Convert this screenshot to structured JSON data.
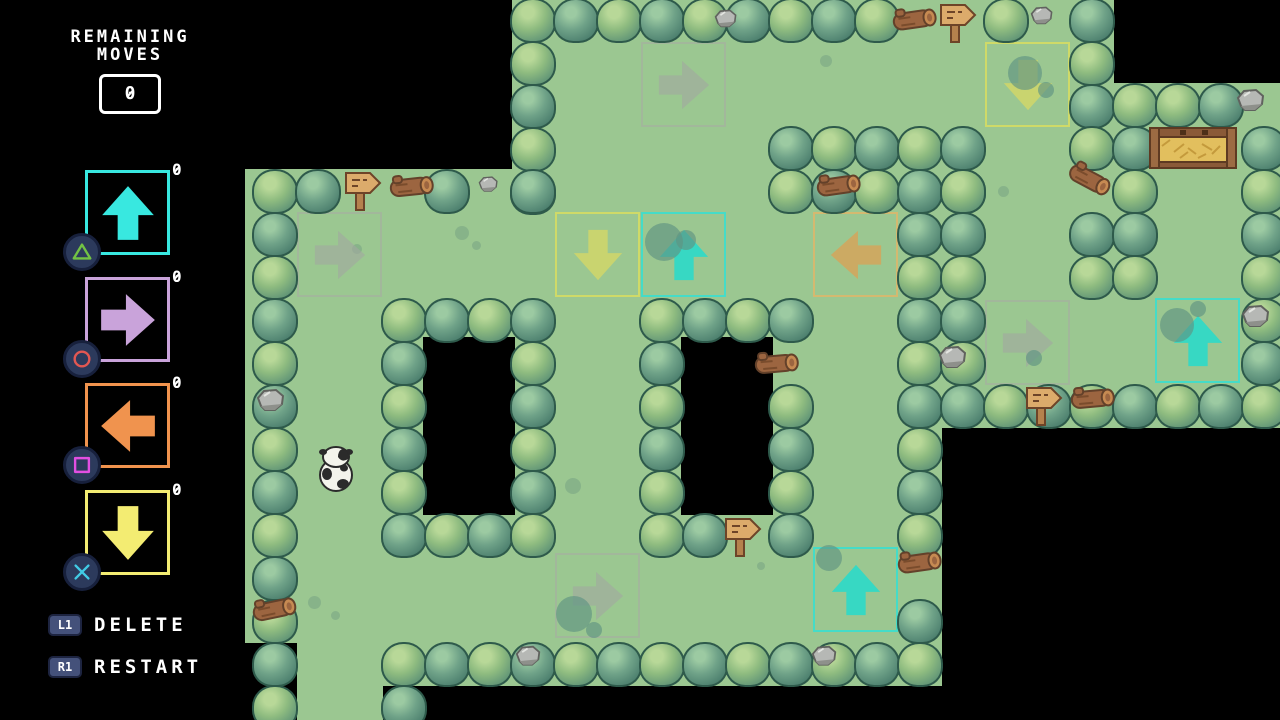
{
  "hud": {
    "remaining_moves": {
      "label_line1": "REMAINING",
      "label_line2": "MOVES",
      "value": "0"
    },
    "arrow_buttons": [
      {
        "direction": "up",
        "count": "0",
        "color": "#38e8e0",
        "ps_button": "triangle",
        "ps_color": "#72c244"
      },
      {
        "direction": "right",
        "count": "0",
        "color": "#c9a3da",
        "ps_button": "circle",
        "ps_color": "#e25752"
      },
      {
        "direction": "left",
        "count": "0",
        "color": "#f0934e",
        "ps_button": "square",
        "ps_color": "#e24fe2"
      },
      {
        "direction": "down",
        "count": "0",
        "color": "#f3ec72",
        "ps_button": "cross",
        "ps_color": "#41cbe4"
      }
    ],
    "shoulder_actions": [
      {
        "button": "L1",
        "label": "DELETE"
      },
      {
        "button": "R1",
        "label": "RESTART"
      }
    ]
  },
  "map": {
    "colors": {
      "background": "#000000",
      "grass": "#9bc791",
      "bush_outline": "#2e5a4b"
    },
    "arrow_styles": {
      "ghost": {
        "border": "rgba(168,170,164,0.55)",
        "fill": "rgba(162,166,160,0.6)"
      },
      "yellow": {
        "border": "rgba(213,219,100,0.9)",
        "fill": "rgba(205,213,108,0.92)"
      },
      "cyan": {
        "border": "rgba(60,222,206,0.9)",
        "fill": "rgba(47,217,200,0.92)"
      },
      "orange": {
        "border": "rgba(222,182,106,0.85)",
        "fill": "rgba(211,166,92,0.88)"
      }
    },
    "grass_rects": [
      {
        "x": 512,
        "y": 0,
        "w": 602,
        "h": 130
      },
      {
        "x": 512,
        "y": 129,
        "w": 430,
        "h": 42
      },
      {
        "x": 942,
        "y": 126,
        "w": 172,
        "h": 174
      },
      {
        "x": 1114,
        "y": 83,
        "w": 172,
        "h": 216
      },
      {
        "x": 942,
        "y": 255,
        "w": 344,
        "h": 173
      },
      {
        "x": 245,
        "y": 169,
        "w": 697,
        "h": 388
      },
      {
        "x": 245,
        "y": 556,
        "w": 697,
        "h": 87
      },
      {
        "x": 383,
        "y": 642,
        "w": 559,
        "h": 44
      },
      {
        "x": 297,
        "y": 642,
        "w": 86,
        "h": 90
      }
    ],
    "pits": [
      {
        "x": 423,
        "y": 337,
        "w": 92,
        "h": 178
      },
      {
        "x": 681,
        "y": 337,
        "w": 92,
        "h": 178
      }
    ],
    "bush_runs": [
      {
        "x": 512,
        "y": -2,
        "n": 9,
        "d": "h",
        "v": 0
      },
      {
        "x": 985,
        "y": -2,
        "n": 1,
        "d": "h",
        "v": 0
      },
      {
        "x": 1071,
        "y": -2,
        "n": 1,
        "d": "h",
        "v": 1
      },
      {
        "x": 512,
        "y": 41,
        "n": 4,
        "d": "v",
        "v": 0
      },
      {
        "x": 1071,
        "y": 41,
        "n": 2,
        "d": "v",
        "v": 0
      },
      {
        "x": 770,
        "y": 126,
        "n": 5,
        "d": "h",
        "v": 1
      },
      {
        "x": 770,
        "y": 169,
        "n": 5,
        "d": "h",
        "v": 0
      },
      {
        "x": 254,
        "y": 169,
        "n": 2,
        "d": "h",
        "v": 0
      },
      {
        "x": 426,
        "y": 169,
        "n": 1,
        "d": "h",
        "v": 1
      },
      {
        "x": 512,
        "y": 169,
        "n": 1,
        "d": "h",
        "v": 1
      },
      {
        "x": 254,
        "y": 212,
        "n": 12,
        "d": "v",
        "v": 1
      },
      {
        "x": 383,
        "y": 298,
        "n": 4,
        "d": "h",
        "v": 0
      },
      {
        "x": 383,
        "y": 341,
        "n": 4,
        "d": "v",
        "v": 1
      },
      {
        "x": 512,
        "y": 341,
        "n": 4,
        "d": "v",
        "v": 0
      },
      {
        "x": 383,
        "y": 513,
        "n": 4,
        "d": "h",
        "v": 1
      },
      {
        "x": 641,
        "y": 298,
        "n": 4,
        "d": "h",
        "v": 0
      },
      {
        "x": 641,
        "y": 341,
        "n": 4,
        "d": "v",
        "v": 1
      },
      {
        "x": 641,
        "y": 513,
        "n": 2,
        "d": "h",
        "v": 0
      },
      {
        "x": 770,
        "y": 384,
        "n": 4,
        "d": "v",
        "v": 0
      },
      {
        "x": 899,
        "y": 212,
        "n": 8,
        "d": "v",
        "v": 1
      },
      {
        "x": 899,
        "y": 599,
        "n": 1,
        "d": "h",
        "v": 1
      },
      {
        "x": 942,
        "y": 169,
        "n": 5,
        "d": "v",
        "v": 0
      },
      {
        "x": 1071,
        "y": 126,
        "n": 1,
        "d": "h",
        "v": 0
      },
      {
        "x": 1071,
        "y": 212,
        "n": 2,
        "d": "v",
        "v": 1
      },
      {
        "x": 1114,
        "y": 83,
        "n": 5,
        "d": "v",
        "v": 0
      },
      {
        "x": 1157,
        "y": 83,
        "n": 2,
        "d": "h",
        "v": 0
      },
      {
        "x": 1243,
        "y": 126,
        "n": 4,
        "d": "v",
        "v": 1
      },
      {
        "x": 1243,
        "y": 298,
        "n": 2,
        "d": "v",
        "v": 0
      },
      {
        "x": 942,
        "y": 384,
        "n": 8,
        "d": "h",
        "v": 1
      },
      {
        "x": 383,
        "y": 642,
        "n": 13,
        "d": "h",
        "v": 0
      },
      {
        "x": 383,
        "y": 685,
        "n": 1,
        "d": "h",
        "v": 1
      }
    ],
    "placed_arrows": [
      {
        "x": 641,
        "y": 42,
        "dir": "right",
        "style": "ghost"
      },
      {
        "x": 985,
        "y": 42,
        "dir": "down",
        "style": "yellow"
      },
      {
        "x": 555,
        "y": 212,
        "dir": "down",
        "style": "yellow"
      },
      {
        "x": 641,
        "y": 212,
        "dir": "up",
        "style": "cyan"
      },
      {
        "x": 813,
        "y": 212,
        "dir": "left",
        "style": "orange"
      },
      {
        "x": 297,
        "y": 212,
        "dir": "right",
        "style": "ghost"
      },
      {
        "x": 985,
        "y": 300,
        "dir": "right",
        "style": "ghost"
      },
      {
        "x": 1155,
        "y": 298,
        "dir": "up",
        "style": "cyan"
      },
      {
        "x": 555,
        "y": 553,
        "dir": "right",
        "style": "ghost"
      },
      {
        "x": 813,
        "y": 547,
        "dir": "up",
        "style": "cyan"
      }
    ],
    "signs": [
      {
        "x": 938,
        "y": 2
      },
      {
        "x": 343,
        "y": 170
      },
      {
        "x": 1024,
        "y": 385
      },
      {
        "x": 723,
        "y": 516
      }
    ],
    "logs": [
      {
        "x": 886,
        "y": 6,
        "r": -8
      },
      {
        "x": 383,
        "y": 173,
        "r": -6
      },
      {
        "x": 810,
        "y": 172,
        "r": -8
      },
      {
        "x": 1060,
        "y": 164,
        "r": 28
      },
      {
        "x": 1064,
        "y": 385,
        "r": -5
      },
      {
        "x": 891,
        "y": 549,
        "r": -8
      },
      {
        "x": 748,
        "y": 350,
        "r": -5
      },
      {
        "x": 246,
        "y": 596,
        "r": -12
      }
    ],
    "rocks": [
      {
        "x": 714,
        "y": 8,
        "s": 0.8
      },
      {
        "x": 1030,
        "y": 5,
        "s": 0.8
      },
      {
        "x": 478,
        "y": 175,
        "s": 0.7
      },
      {
        "x": 1236,
        "y": 87,
        "s": 1
      },
      {
        "x": 1241,
        "y": 303,
        "s": 1
      },
      {
        "x": 938,
        "y": 344,
        "s": 1
      },
      {
        "x": 256,
        "y": 387,
        "s": 1
      },
      {
        "x": 515,
        "y": 644,
        "s": 0.9
      },
      {
        "x": 811,
        "y": 644,
        "s": 0.9
      }
    ],
    "spots": [
      {
        "x": 455,
        "y": 226,
        "d": 14
      },
      {
        "x": 472,
        "y": 241,
        "d": 9
      },
      {
        "x": 820,
        "y": 55,
        "d": 12
      },
      {
        "x": 1093,
        "y": 218,
        "d": 10
      },
      {
        "x": 998,
        "y": 186,
        "d": 11
      },
      {
        "x": 565,
        "y": 478,
        "d": 16
      },
      {
        "x": 308,
        "y": 596,
        "d": 13
      },
      {
        "x": 331,
        "y": 611,
        "d": 9
      },
      {
        "x": 757,
        "y": 562,
        "d": 8
      },
      {
        "x": 352,
        "y": 244,
        "d": 10
      }
    ],
    "blobs": [
      {
        "x": 645,
        "y": 223,
        "d": 38
      },
      {
        "x": 676,
        "y": 230,
        "d": 20
      },
      {
        "x": 1008,
        "y": 56,
        "d": 34
      },
      {
        "x": 1038,
        "y": 82,
        "d": 16
      },
      {
        "x": 1160,
        "y": 308,
        "d": 34
      },
      {
        "x": 1190,
        "y": 301,
        "d": 16
      },
      {
        "x": 816,
        "y": 545,
        "d": 26
      },
      {
        "x": 556,
        "y": 596,
        "d": 36
      },
      {
        "x": 586,
        "y": 622,
        "d": 16
      },
      {
        "x": 1026,
        "y": 350,
        "d": 16
      }
    ],
    "cow": {
      "x": 314,
      "y": 444
    },
    "gate": {
      "x": 1148,
      "y": 124
    }
  }
}
